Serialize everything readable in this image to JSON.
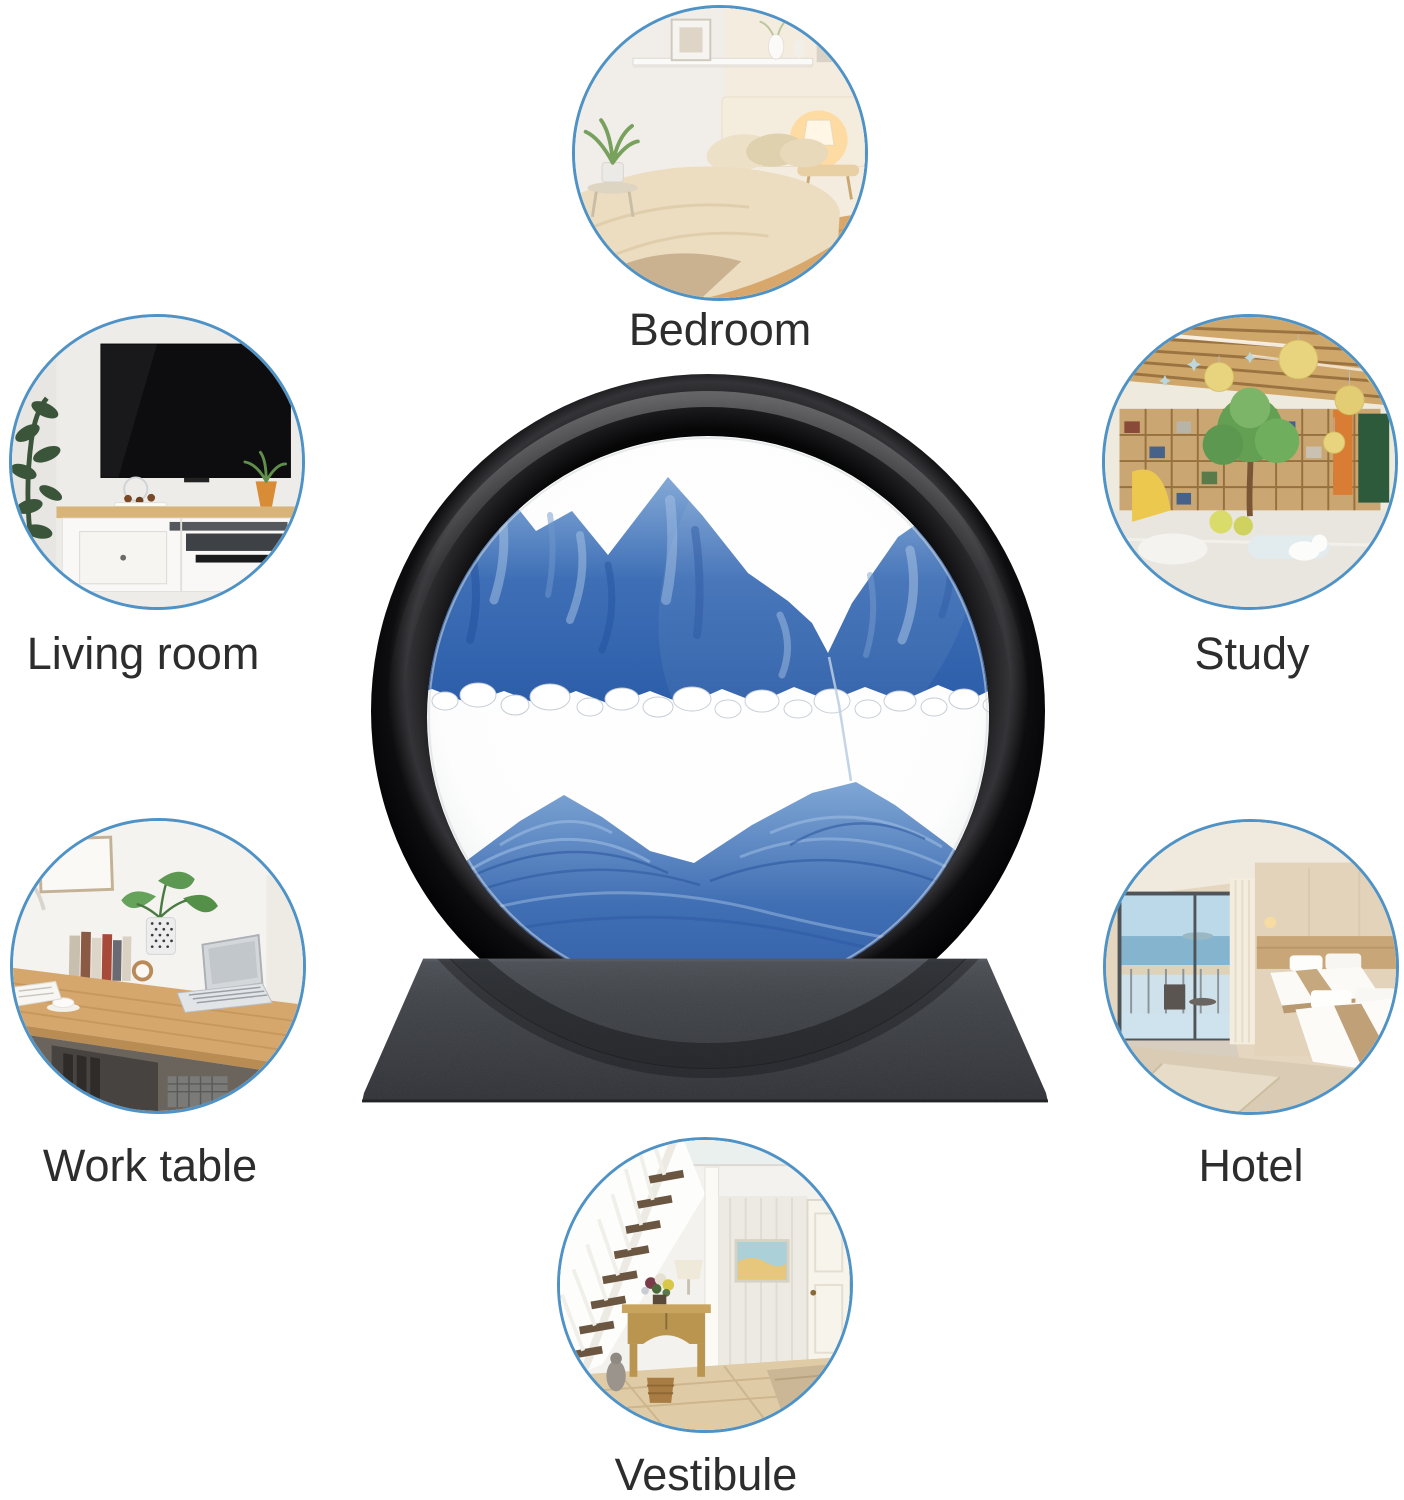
{
  "page": {
    "background_color": "#ffffff"
  },
  "collage": {
    "circle_border_color": "#4e92c6",
    "label_color": "#2d2d2d",
    "scenes": [
      {
        "id": "bedroom",
        "label": "Bedroom"
      },
      {
        "id": "living-room",
        "label": "Living room"
      },
      {
        "id": "study",
        "label": "Study"
      },
      {
        "id": "work-table",
        "label": "Work table"
      },
      {
        "id": "hotel",
        "label": "Hotel"
      },
      {
        "id": "vestibule",
        "label": "Vestibule"
      }
    ]
  },
  "product": {
    "kind": "moving-sand-art-picture",
    "frame_color": "#0e0e10",
    "base_color": "#3c3f45",
    "glass_color": "#ffffff",
    "sand_color_primary": "#3f6db4",
    "sand_color_light": "#8fb3dc",
    "sand_color_dark": "#27549f"
  }
}
